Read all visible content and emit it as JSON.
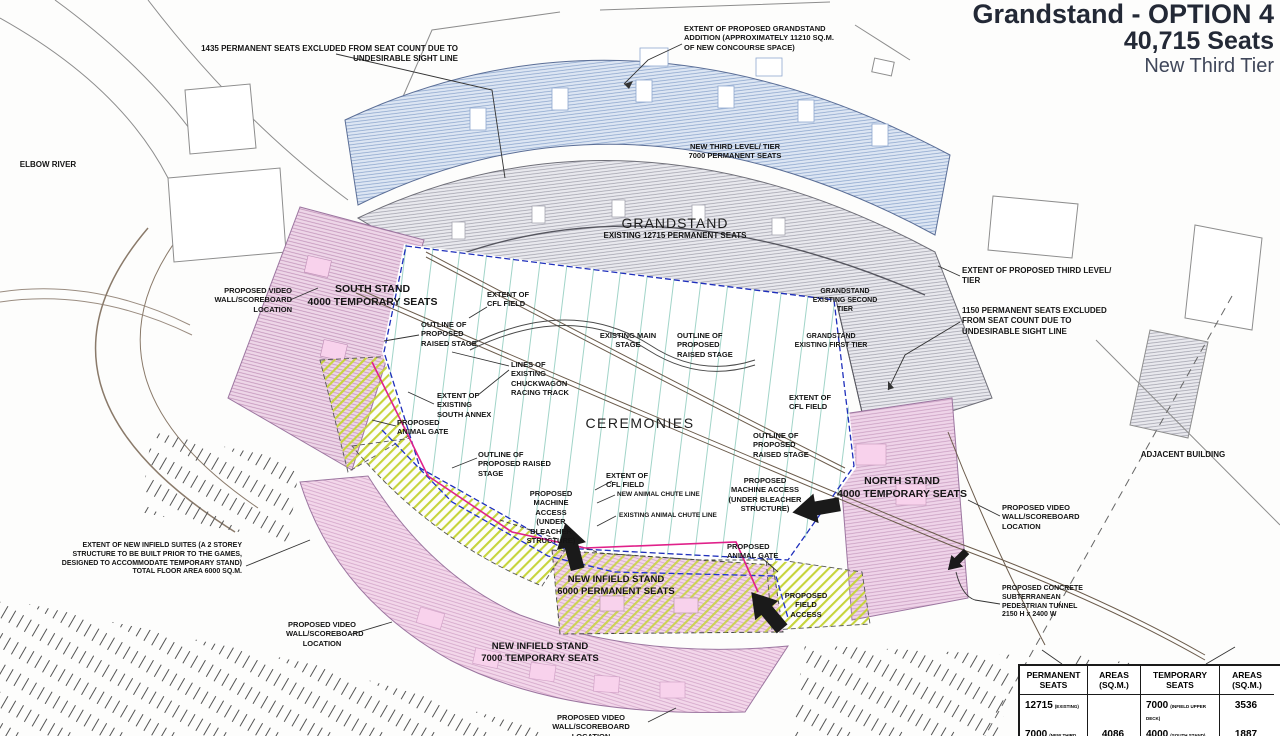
{
  "title": {
    "line1": "Grandstand - OPTION 4",
    "line2": "40,715 Seats",
    "line3": "New Third Tier"
  },
  "labels": {
    "excluded_1435": "1435 PERMANENT SEATS EXCLUDED FROM SEAT COUNT DUE TO UNDESIRABLE SIGHT LINE",
    "elbow_river": "ELBOW RIVER",
    "extent_addition": "EXTENT OF PROPOSED GRANDSTAND ADDITION (APPROXIMATELY 11210 SQ.M. OF NEW CONCOURSE SPACE)",
    "new_third_level": "NEW THIRD LEVEL/ TIER",
    "new_third_level_seats": "7000 PERMANENT SEATS",
    "grandstand": "GRANDSTAND",
    "grandstand_existing": "EXISTING 12715 PERMANENT SEATS",
    "video_wall": "PROPOSED VIDEO WALL/SCOREBOARD LOCATION",
    "south_stand": "SOUTH STAND",
    "south_stand_seats": "4000 TEMPORARY SEATS",
    "outline_raised_stage": "OUTLINE OF PROPOSED RAISED STAGE",
    "extent_cfl": "EXTENT OF CFL FIELD",
    "chuckwagon": "LINES OF EXISTING CHUCKWAGON RACING TRACK",
    "existing_main_stage": "EXISTING MAIN STAGE",
    "south_annex": "EXTENT OF EXISTING SOUTH ANNEX",
    "animal_gate": "PROPOSED ANIMAL GATE",
    "ceremonies": "CEREMONIES",
    "second_tier": "GRANDSTAND EXISTING SECOND TIER",
    "first_tier": "GRANDSTAND EXISTING FIRST TIER",
    "extent_third_level": "EXTENT OF PROPOSED THIRD LEVEL/ TIER",
    "excluded_1150": "1150 PERMANENT SEATS EXCLUDED FROM SEAT COUNT DUE TO UNDESIRABLE SIGHT LINE",
    "north_stand": "NORTH STAND",
    "north_stand_seats": "4000 TEMPORARY SEATS",
    "machine_access": "PROPOSED MACHINE ACCESS (UNDER BLEACHER STRUCTURE)",
    "new_chute": "NEW ANIMAL CHUTE LINE",
    "existing_chute": "EXISTING ANIMAL CHUTE LINE",
    "infield_6000": "NEW INFIELD STAND",
    "infield_6000_seats": "6000 PERMANENT SEATS",
    "field_access": "PROPOSED FIELD ACCESS",
    "infield_suites": "EXTENT OF NEW INFIELD SUITES (A 2 STOREY STRUCTURE TO BE BUILT PRIOR TO THE GAMES, DESIGNED TO ACCOMMODATE TEMPORARY STAND) TOTAL FLOOR AREA 6000 SQ.M.",
    "infield_7000": "NEW INFIELD STAND",
    "infield_7000_seats": "7000 TEMPORARY SEATS",
    "tunnel": "PROPOSED CONCRETE SUBTERRANEAN PEDESTRIAN TUNNEL 2150 H x 2400 W",
    "adjacent_building": "ADJACENT BUILDING"
  },
  "table": {
    "headers": [
      "PERMANENT SEATS",
      "AREAS (SQ.M.)",
      "TEMPORARY SEATS",
      "AREAS (SQ.M.)"
    ],
    "rows": [
      {
        "c1": "12715",
        "c1n": "(EXISTING)",
        "c2": "",
        "c3": "7000",
        "c3n": "(INFIELD UPPER DECK)",
        "c4": "3536"
      },
      {
        "c1": "7000",
        "c1n": "(NEW THIRD LEVEL/ TIER)",
        "c2": "4086",
        "c3": "4000",
        "c3n": "(SOUTH STAND)",
        "c4": "1887"
      }
    ]
  },
  "colors": {
    "title_navy": "#232936",
    "third_tier_fill": "#dde6f3",
    "existing_fill": "#e8e8ed",
    "stand_pink": "#eed6e8",
    "suites_yellow": "#ccd840",
    "field_line_teal": "#96cfc2",
    "chute_blue": "#2233cc",
    "chute_red": "#e0218a"
  }
}
